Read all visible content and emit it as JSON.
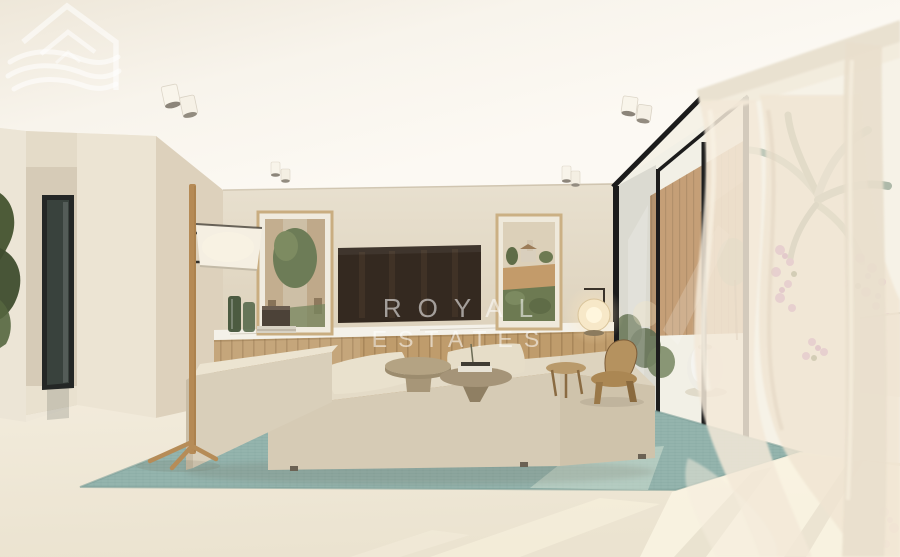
{
  "image": {
    "width": 900,
    "height": 557,
    "description": "3D architectural render of a modern beige living room with teal rug, wood sideboard, framed art, glass sliding doors to a terrace and sheer curtains, overlaid with a Royal Estates watermark"
  },
  "watermark": {
    "line1": "ROYAL",
    "line2": "ESTATES",
    "logo": "house-roof-with-waves",
    "color": "#ffffff",
    "opacity": 0.55
  },
  "palette": {
    "ceiling": "#f8f4ec",
    "wall": "#e4dbc8",
    "column": "#ece4d3",
    "floor": "#f1ead9",
    "sun_patch": "#faf4e3",
    "rug": "#8fb0a9",
    "rug_sunlit": "#cfe0d2",
    "sofa": "#d6cbb5",
    "sofa_top": "#e6ddc9",
    "wood": "#bf9c6c",
    "marble": "#f4f1e9",
    "tv": "#342920",
    "frame_black": "#1c1c1c",
    "curtain": "#f3e9d8",
    "plant_green": "#55663f",
    "olive_green": "#73824f",
    "bougainvillea": "#c47fc4",
    "palm_silver": "#bcc7b8",
    "vase_white": "#f2efe6"
  }
}
